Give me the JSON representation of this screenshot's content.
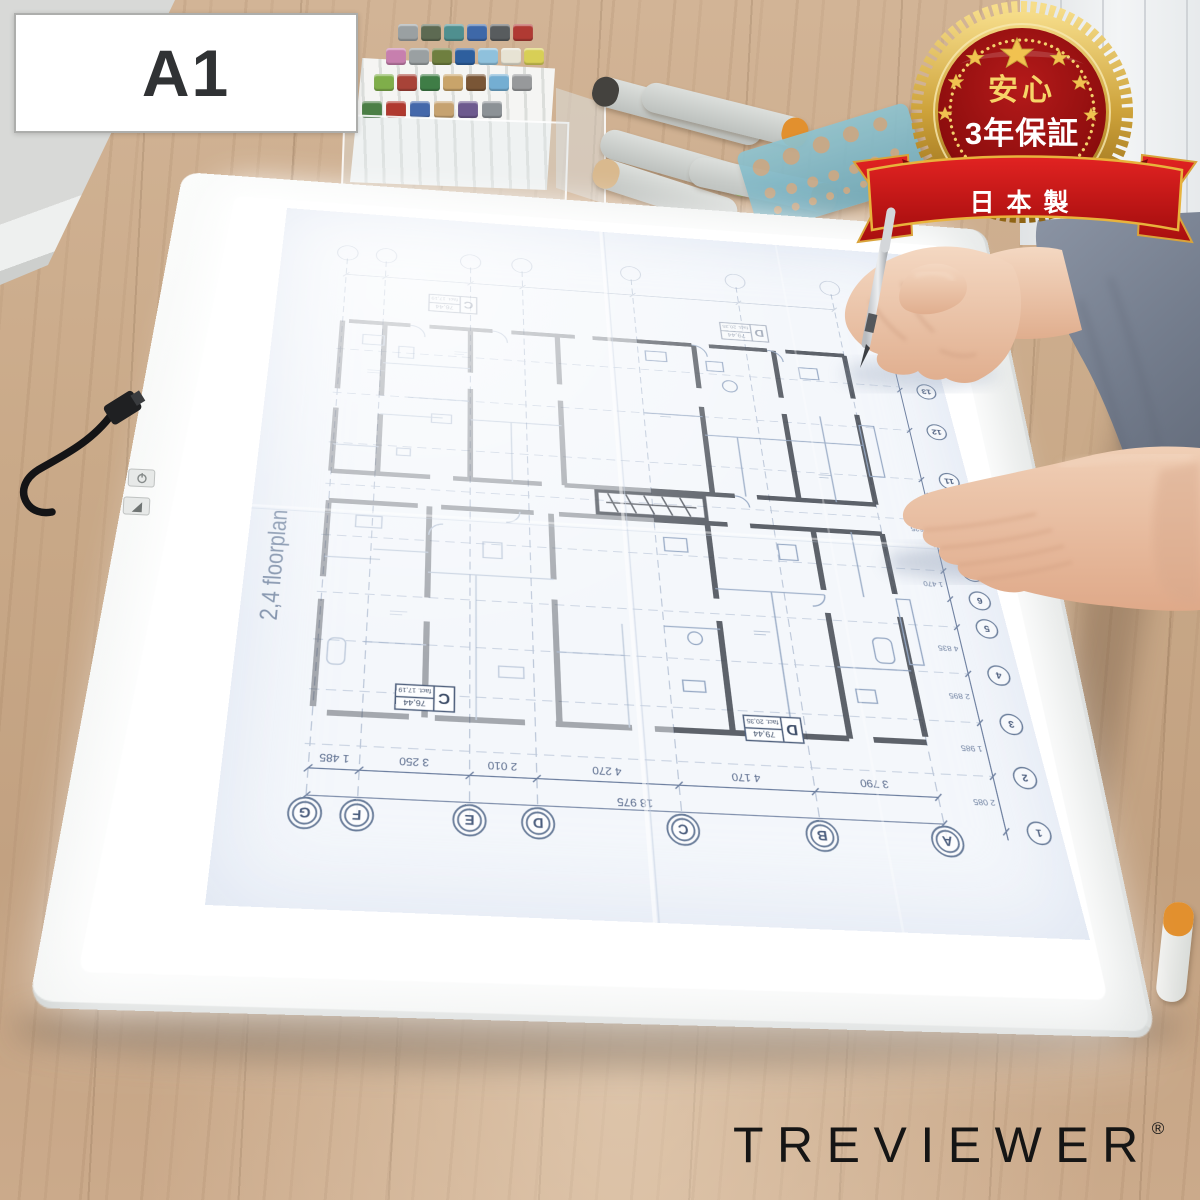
{
  "size_label": {
    "text": "A1"
  },
  "badge": {
    "top_text": "安心",
    "main_text": "3年保証",
    "ribbon_text": "日本製",
    "stars": 7,
    "colors": {
      "gold": "#d9a93c",
      "dark_red": "#7a0909",
      "ribbon_red": "#c41616"
    }
  },
  "brand": {
    "name": "TREVIEWER",
    "registered_mark": "®"
  },
  "blueprint": {
    "title": "2,4 floorplan",
    "grid_letters": [
      "G",
      "F",
      "E",
      "D",
      "C",
      "B",
      "A"
    ],
    "grid_numbers": [
      "1",
      "2",
      "3",
      "4",
      "5",
      "6",
      "7",
      "8",
      "9",
      "10",
      "11",
      "12",
      "13"
    ],
    "dims_bottom": [
      "1 485",
      "3 250",
      "2 010",
      "4 270",
      "4 170",
      "3 790"
    ],
    "dims_total": "18 975",
    "dims_right": [
      "2 085",
      "1 985",
      "2 895",
      "4 835",
      "1 470",
      "1 625"
    ],
    "stamps": [
      {
        "letter": "C",
        "area": "76,44",
        "note": "fact. 17,19"
      },
      {
        "letter": "D",
        "area": "79,44",
        "note": "fact. 20,35"
      }
    ]
  },
  "device": {
    "buttons": [
      "power",
      "brightness"
    ]
  },
  "markers": {
    "cap_colors": [
      "#9aa0a2",
      "#5d6a52",
      "#4f8f8f",
      "#3e68a8",
      "#585c5e",
      "#b03a33",
      "#c77fae",
      "#9aa0a2",
      "#6f7f3f",
      "#2e5f9e",
      "#8fc1dc",
      "#e7e3d4",
      "#d8cf56",
      "#7fae4a",
      "#a84338",
      "#3f7d46",
      "#c9a46a",
      "#7a5636",
      "#74aed2",
      "#97999b",
      "#4b7f45",
      "#b0392f",
      "#4468aa",
      "#c6a270",
      "#6d5a8e",
      "#8c9296"
    ],
    "loose_tip_colors": [
      "#44423e",
      "#e2902e",
      "#8fbf57",
      "#d9b98e",
      "#e8a96a",
      "#e2902e"
    ]
  },
  "palette": {
    "wood": "#c9a886",
    "frame_white": "#f1f3f2",
    "glow": "#ffffff",
    "paper": "#f4f7fb",
    "plan_blue": "#8298b8",
    "plan_wall": "#3a3f48",
    "skin": "#e9c3a8",
    "sleeve": "#7b8494"
  }
}
